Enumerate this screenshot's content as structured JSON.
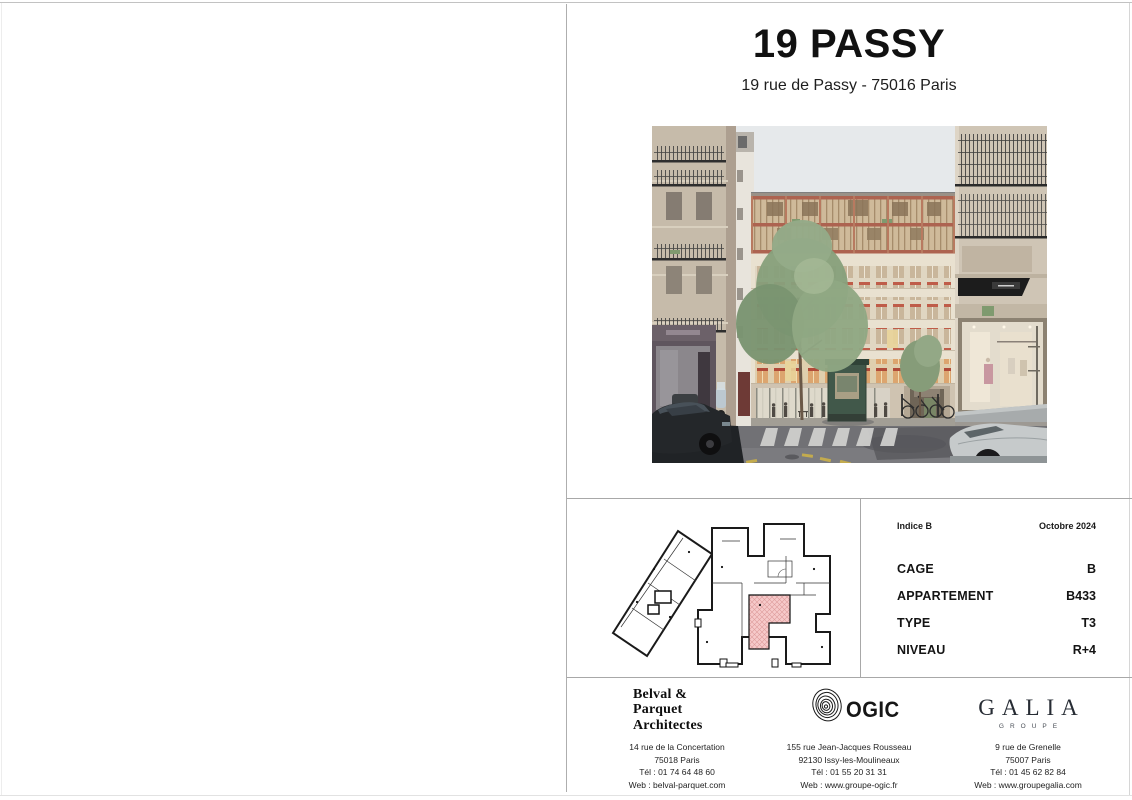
{
  "page": {
    "title": "19 PASSY",
    "subtitle": "19 rue de Passy - 75016 Paris"
  },
  "info_panel": {
    "indice": "Indice B",
    "date": "Octobre 2024",
    "rows": [
      {
        "label": "CAGE",
        "value": "B"
      },
      {
        "label": "APPARTEMENT",
        "value": "B433"
      },
      {
        "label": "TYPE",
        "value": "T3"
      },
      {
        "label": "NIVEAU",
        "value": "R+4"
      }
    ]
  },
  "footer": {
    "architect": {
      "name_lines": [
        "Belval &",
        "Parquet",
        "Architectes"
      ],
      "address": [
        "14 rue de la Concertation",
        "75018 Paris",
        "Tél : 01 74 64 48 60",
        "Web : belval-parquet.com"
      ]
    },
    "ogic": {
      "name": "OGIC",
      "address": [
        "155 rue Jean-Jacques Rousseau",
        "92130 Issy-les-Moulineaux",
        "Tél : 01 55 20 31 31",
        "Web : www.groupe-ogic.fr"
      ]
    },
    "galia": {
      "name": "GALIA",
      "subname": "GROUPE",
      "address": [
        "9 rue de Grenelle",
        "75007 Paris",
        "Tél : 01 45 62 82 84",
        "Web : www.groupegalia.com"
      ]
    }
  },
  "colors": {
    "plan_highlight": "#f6caca",
    "accent_red": "#bf5c49",
    "kiosk_green": "#41584a"
  }
}
